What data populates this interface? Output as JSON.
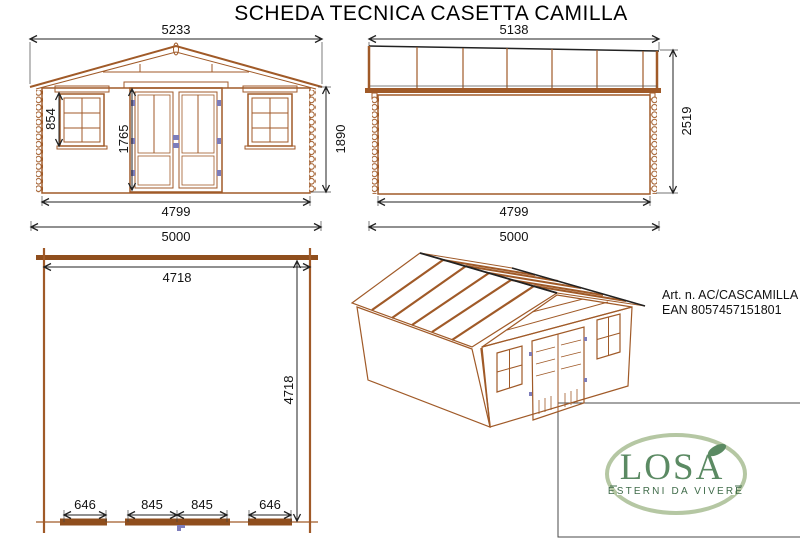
{
  "title": "SCHEDA TECNICA CASETTA CAMILLA",
  "front_view": {
    "label": "front-elevation",
    "dim_total_width": "5233",
    "dim_window_height": "854",
    "dim_door_height": "1765",
    "dim_wall_height": "1890",
    "dim_inner_width": "4799",
    "dim_base_width": "5000"
  },
  "side_view": {
    "label": "side-elevation",
    "dim_total_width": "5138",
    "dim_total_height": "2519",
    "dim_inner_width": "4799",
    "dim_base_width": "5000"
  },
  "plan_view": {
    "label": "floor-plan",
    "dim_inner_width": "4718",
    "dim_inner_depth": "4718",
    "dim_window_left": "646",
    "dim_door_leaf_left": "845",
    "dim_door_leaf_right": "845",
    "dim_window_right": "646"
  },
  "product": {
    "article": "Art. n. AC/CASCAMILLA",
    "ean": "EAN 8057457151801"
  },
  "logo": {
    "name": "LOSA",
    "tagline": "ESTERNI DA VIVERE"
  },
  "colors": {
    "wood": "#a05a28",
    "wood_dark": "#8f4e1d",
    "dimension": "#222222",
    "hinge_blue": "#7d7dbb",
    "logo_green": "#5b8a63",
    "logo_oval": "#b5c7a3"
  }
}
